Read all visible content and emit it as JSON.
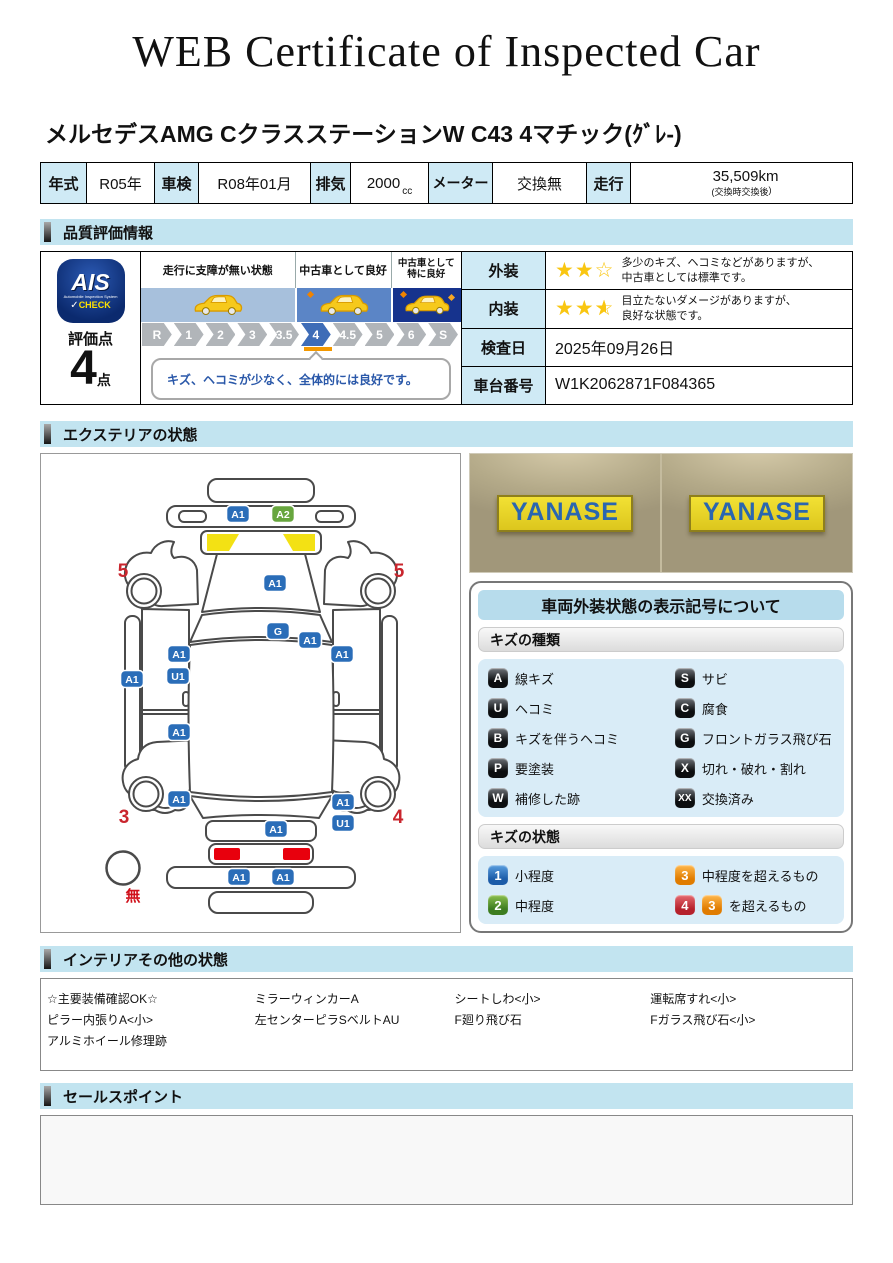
{
  "title": "WEB Certificate of Inspected Car",
  "car_name": "メルセデスAMG CクラスステーションW C43 4マチック(ｸﾞﾚ-)",
  "spec": {
    "year_label": "年式",
    "year_value": "R05年",
    "shaken_label": "車検",
    "shaken_value": "R08年01月",
    "disp_label": "排気",
    "disp_value": "2000",
    "disp_unit": "cc",
    "meter_label": "メーター",
    "meter_value": "交換無",
    "run_label": "走行",
    "run_value": "35,509km",
    "run_note_open": "(交換時",
    "run_note_mid": "交換後",
    "run_note_close": ")"
  },
  "sections": {
    "quality": "品質評価情報",
    "exterior": "エクステリアの状態",
    "interior": "インテリアその他の状態",
    "sales": "セールスポイント"
  },
  "icons": {
    "star_full": "★",
    "star_empty": "☆",
    "check_icon": "✓"
  },
  "colors": {
    "blue": "#2a6db8",
    "green": "#67a63e",
    "orange": "#ef9421",
    "red": "#cf2e39",
    "accent_lightblue": "#c2e4f0",
    "cell_lightblue": "#cfeaf5",
    "marker_orange": "#f39800"
  },
  "evaluation": {
    "logo_main": "AIS",
    "logo_sub": "Automobile Inspection System",
    "logo_check": "CHECK",
    "score_label": "評価点",
    "score_value": "4",
    "score_unit": "点",
    "zone_labels": [
      "走行に支障が無い状態",
      "中古車として良好",
      "中古車として特に良好"
    ],
    "scale": [
      "R",
      "1",
      "2",
      "3",
      "3.5",
      "4",
      "4.5",
      "5",
      "6",
      "S"
    ],
    "selected": "4",
    "comment": "キズ、ヘコミが少なく、全体的には良好です。",
    "rows": {
      "exterior_label": "外装",
      "exterior_stars": 2,
      "exterior_lines": [
        "多少のキズ、ヘコミなどがありますが、",
        "中古車としては標準です。"
      ],
      "interior_label": "内装",
      "interior_stars": 2.5,
      "interior_lines": [
        "目立たないダメージがありますが、",
        "良好な状態です。"
      ],
      "date_label": "検査日",
      "date_value": "2025年09月26日",
      "vin_label": "車台番号",
      "vin_value": "W1K2062871F084365"
    }
  },
  "photo": {
    "sign_text": "YANASE"
  },
  "diagram": {
    "badges": [
      {
        "t": "A1",
        "c": "blue",
        "x": 197,
        "y": 60
      },
      {
        "t": "A2",
        "c": "green",
        "x": 242,
        "y": 60
      },
      {
        "t": "A1",
        "c": "blue",
        "x": 234,
        "y": 129
      },
      {
        "t": "G",
        "c": "blue",
        "x": 237,
        "y": 177
      },
      {
        "t": "A1",
        "c": "blue",
        "x": 269,
        "y": 186
      },
      {
        "t": "A1",
        "c": "blue",
        "x": 138,
        "y": 200
      },
      {
        "t": "U1",
        "c": "blue",
        "x": 137,
        "y": 222
      },
      {
        "t": "A1",
        "c": "blue",
        "x": 91,
        "y": 225
      },
      {
        "t": "A1",
        "c": "blue",
        "x": 301,
        "y": 200
      },
      {
        "t": "A1",
        "c": "blue",
        "x": 138,
        "y": 278
      },
      {
        "t": "A1",
        "c": "blue",
        "x": 138,
        "y": 345
      },
      {
        "t": "A1",
        "c": "blue",
        "x": 302,
        "y": 348
      },
      {
        "t": "U1",
        "c": "blue",
        "x": 302,
        "y": 369
      },
      {
        "t": "A1",
        "c": "blue",
        "x": 235,
        "y": 375
      },
      {
        "t": "A1",
        "c": "blue",
        "x": 198,
        "y": 423
      },
      {
        "t": "A1",
        "c": "blue",
        "x": 242,
        "y": 423
      }
    ],
    "numbers": [
      {
        "t": "5",
        "x": 82,
        "y": 123
      },
      {
        "t": "5",
        "x": 358,
        "y": 123
      },
      {
        "t": "3",
        "x": 83,
        "y": 369
      },
      {
        "t": "4",
        "x": 357,
        "y": 369
      }
    ],
    "spare_label": "無"
  },
  "legend": {
    "title": "車両外装状態の表示記号について",
    "kinds_header": "キズの種類",
    "kinds": [
      {
        "badge": "A",
        "label": "線キズ"
      },
      {
        "badge": "S",
        "label": "サビ"
      },
      {
        "badge": "U",
        "label": "ヘコミ"
      },
      {
        "badge": "C",
        "label": "腐食"
      },
      {
        "badge": "B",
        "label": "キズを伴うヘコミ"
      },
      {
        "badge": "G",
        "label": "フロントガラス飛び石"
      },
      {
        "badge": "P",
        "label": "要塗装"
      },
      {
        "badge": "X",
        "label": "切れ・破れ・割れ"
      },
      {
        "badge": "W",
        "label": "補修した跡"
      },
      {
        "badge": "XX",
        "label": "交換済み"
      }
    ],
    "states_header": "キズの状態",
    "states": [
      {
        "badge": "1",
        "color": "blue",
        "label": "小程度"
      },
      {
        "badge": "3",
        "color": "orange",
        "label": "中程度を超えるもの"
      },
      {
        "badge": "2",
        "color": "green",
        "label": "中程度"
      },
      {
        "badge": "4",
        "color": "red",
        "extra_badge": "3",
        "extra_color": "orange",
        "label": "を超えるもの"
      }
    ]
  },
  "interior_items": [
    "☆主要装備確認OK☆",
    "ミラーウィンカーA",
    "シートしわ<小>",
    "運転席すれ<小>",
    "ピラー内張りA<小>",
    "左センターピラSベルトAU",
    "F廻り飛び石",
    "Fガラス飛び石<小>",
    "アルミホイール修理跡"
  ]
}
